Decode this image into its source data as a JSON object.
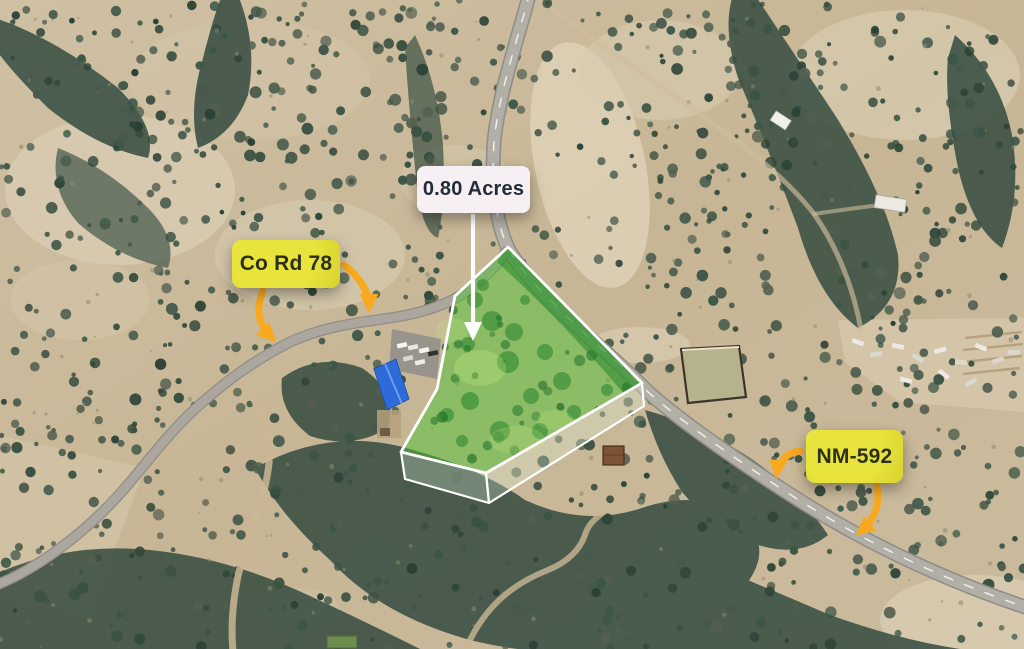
{
  "map": {
    "scene": "Aerial satellite view of a highlighted land parcel at the junction of Co Rd 78 and NM-592",
    "parcel": {
      "area_text": "0.80 Acres",
      "fill_color": "#4fc235",
      "outline_color": "#ffffff"
    },
    "labels": {
      "acreage": {
        "text": "0.80 Acres",
        "bg": "#f6eff3",
        "fg": "#232c39"
      },
      "co_rd": {
        "text": "Co Rd 78",
        "bg": "#e9e33d",
        "bg_deep": "#d7d22c",
        "fg": "#2c3118"
      },
      "nm": {
        "text": "NM-592",
        "bg": "#e9e33d",
        "bg_deep": "#d7d22c",
        "fg": "#2c3118"
      }
    },
    "arrows": {
      "color": "#f9a91f",
      "pointer_color": "#ffffff"
    },
    "terrain": {
      "ground": "#c9b897",
      "pale_ground": "#dbd0b8",
      "tree_dark": "#3d5245",
      "paved_road": "#b2afa7",
      "dirt_road": "#cbb794",
      "blue_roof": "#2e6bd8"
    }
  }
}
